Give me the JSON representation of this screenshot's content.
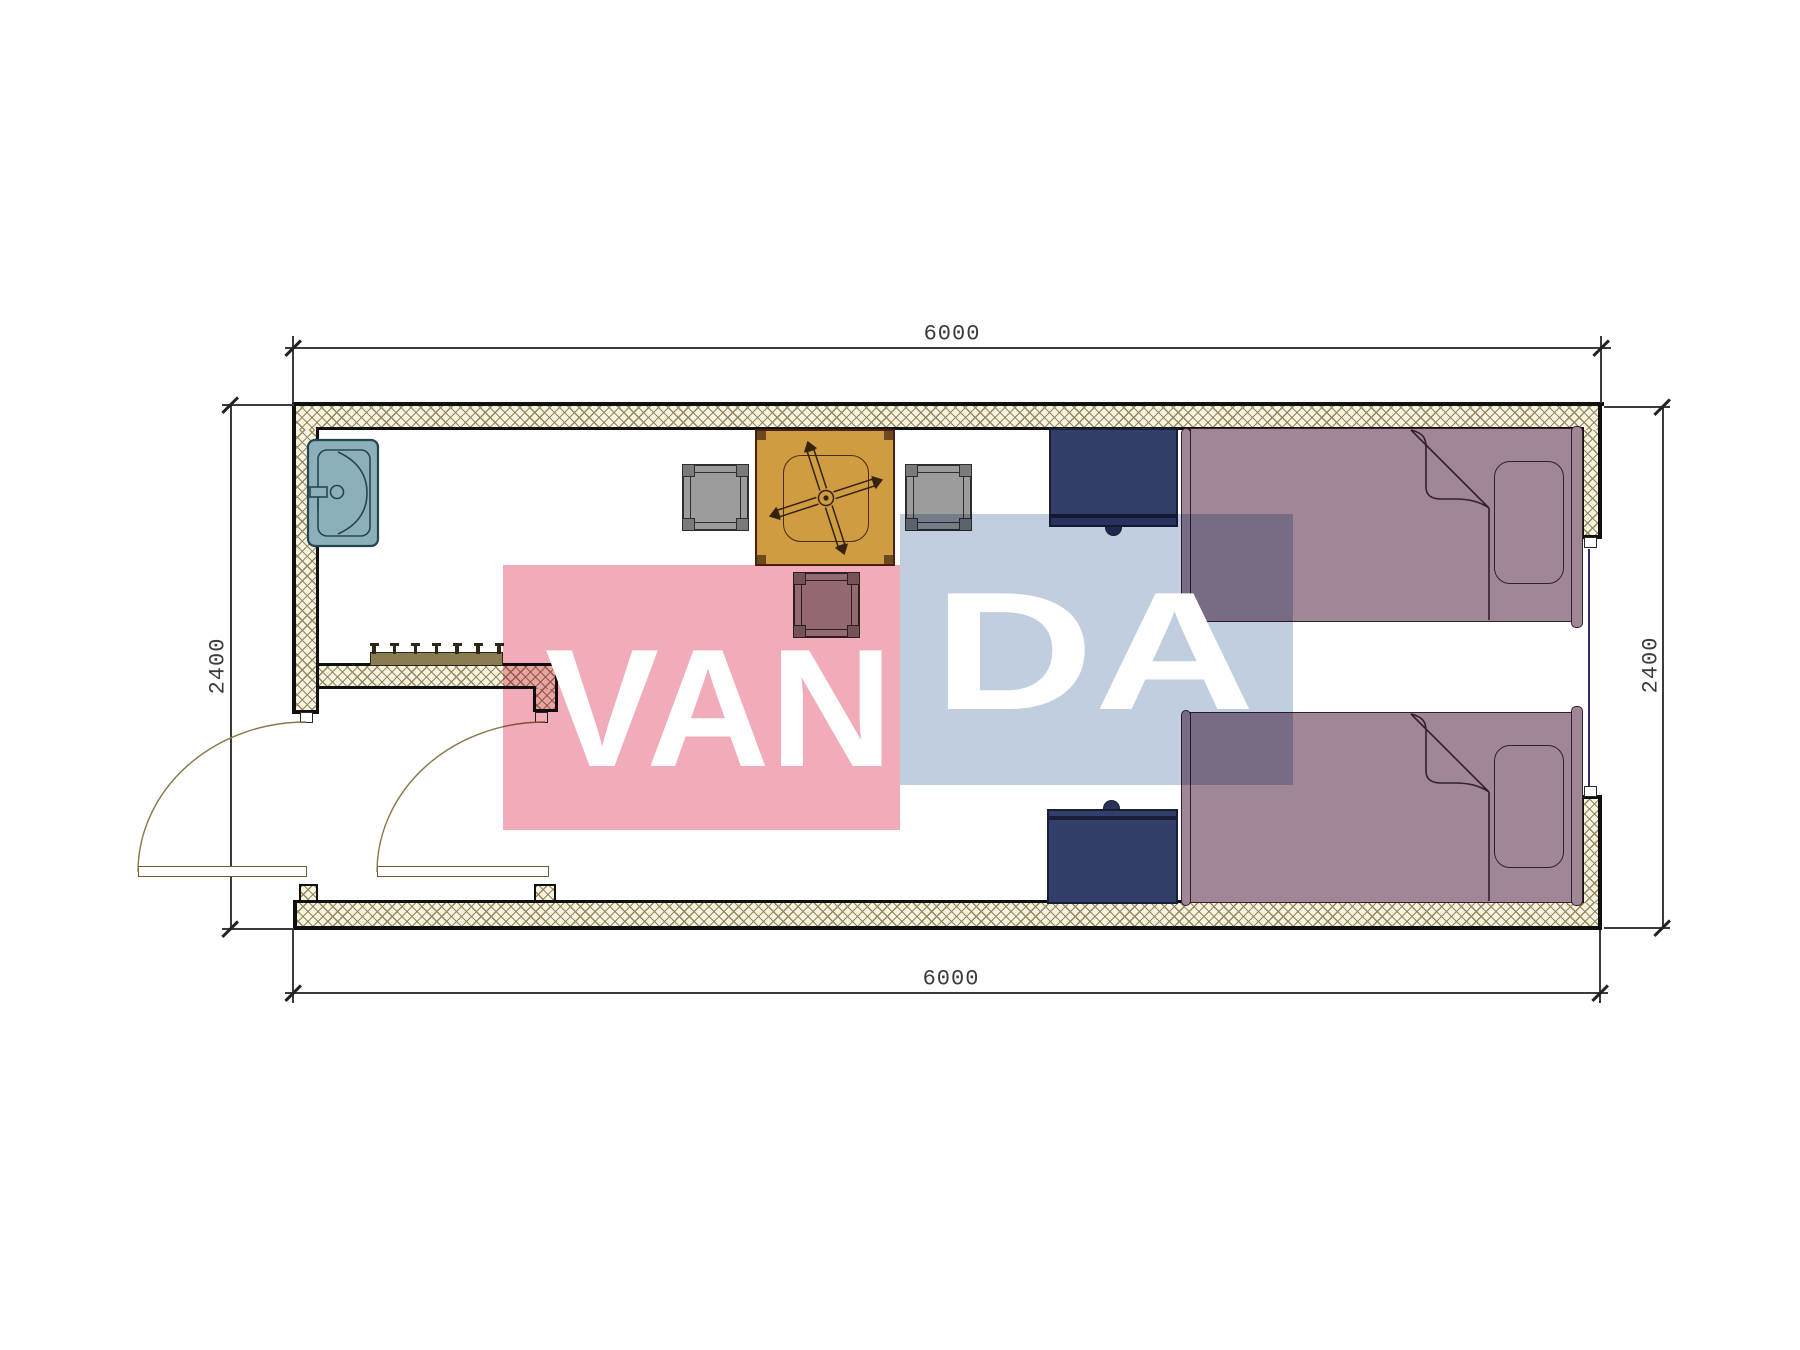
{
  "page": {
    "type": "architectural floor plan",
    "background": "#ffffff"
  },
  "dimensions": {
    "top": {
      "label": "6000"
    },
    "bottom": {
      "label": "6000"
    },
    "left": {
      "label": "2400"
    },
    "right": {
      "label": "2400"
    }
  },
  "watermark": {
    "text": "VANDA",
    "segment_pink": "VAN",
    "segment_blue": "DA",
    "pink_color": "#f2abb8",
    "blue_color": "#c0cedf",
    "text_color": "#ffffff"
  },
  "plan": {
    "wall_fill": "#f7f3e3",
    "hatch_line_color": "#96875a",
    "outline_color": "#101010",
    "window_line_color": "#2c2c6e",
    "door_color": "#6d5d33",
    "furniture": {
      "sink": {
        "color": "#8cb0ba",
        "outline": "#27454f"
      },
      "table_with_fan": {
        "color": "#cf9c42",
        "outline": "#4a2012"
      },
      "stools": {
        "count": 3,
        "color": "#9c9c9c"
      },
      "nightstands": {
        "count": 2,
        "color": "#333f6b"
      },
      "beds": {
        "count": 2,
        "color": "#a08697"
      },
      "coat_rack": {
        "hooks": 7,
        "color": "#8a7c52"
      }
    }
  }
}
